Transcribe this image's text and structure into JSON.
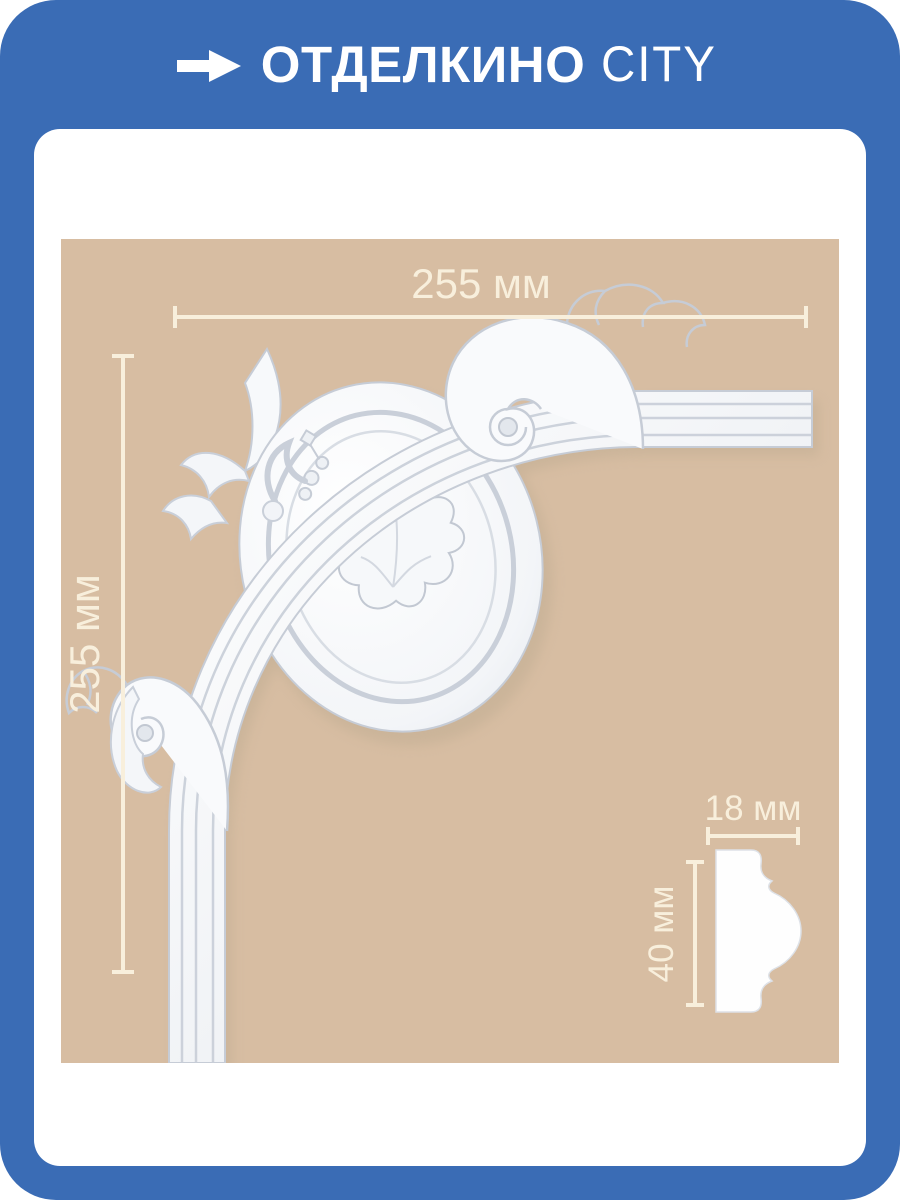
{
  "brand": {
    "name": "ОТДЕЛКИНО",
    "suffix": "CITY",
    "arrow_icon": "right-arrow"
  },
  "theme": {
    "frame_blue": "#3a6cb5",
    "photo_beige": "#d7bda2",
    "annotation_cream": "#f8efdc",
    "card_white": "#ffffff",
    "molding_white": "#fbfcfd",
    "molding_shadow": "#c7cdd7",
    "cast_shadow": "#b9a88e"
  },
  "diagram": {
    "subject": "decorative corner molding with profile cross-section",
    "corner_width": "255 мм",
    "corner_height": "255 мм",
    "profile_width": "18 мм",
    "profile_height": "40 мм"
  }
}
